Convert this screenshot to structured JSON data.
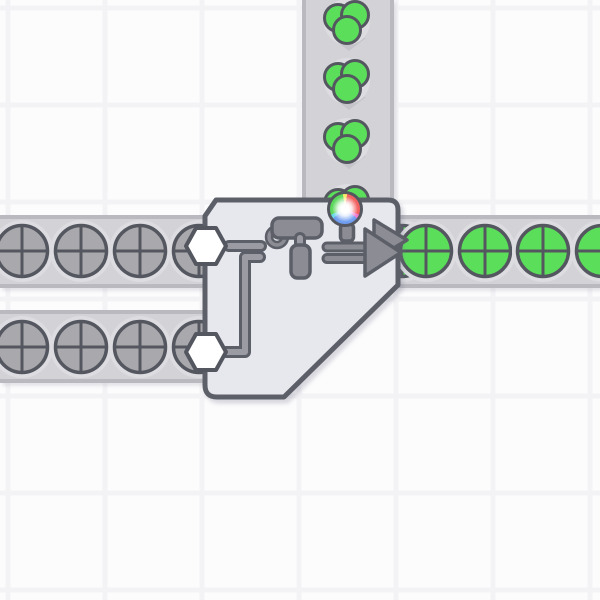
{
  "scene": {
    "kind": "factory-game-world",
    "background": {
      "color": "#fcfcfd",
      "grid": {
        "step": 97,
        "offset": 8,
        "line_width": 5,
        "line_color": "#f3f3f6"
      }
    },
    "colors": {
      "bg": "#fcfcfd",
      "grid-line": "#f3f3f6",
      "belt_fill": "#d2d2d7",
      "belt_edge": "#b9b9bf",
      "chevron": "#c4c4ca",
      "halo": "#dcdce1",
      "shape_grey": "#a9a9ad",
      "item_green": "#5bdf5b",
      "outline": "#54575f",
      "building_fill": "#e7e7ee",
      "building_outline": "#5c5f68",
      "icon_grey": "#8c8c94",
      "pipe_grey": "#9b9ba3",
      "hexagon_fill": "#ffffff",
      "wheel": {
        "red": "#f2605f",
        "green": "#5bd75b",
        "blue": "#6f9df0",
        "yellow": "#f4e96d",
        "cyan": "#6cd8e5",
        "magenta": "#ee7bd1",
        "center": "#ffffff"
      }
    },
    "belts": [
      {
        "name": "conveyor-belt-vertical-input",
        "orientation": "vertical",
        "direction": "down",
        "x": 302,
        "y": 0,
        "w": 92,
        "h": 203
      },
      {
        "name": "conveyor-belt-left-top",
        "orientation": "horizontal",
        "direction": "right",
        "x": 0,
        "y": 215,
        "w": 214,
        "h": 73
      },
      {
        "name": "conveyor-belt-left-bottom",
        "orientation": "horizontal",
        "direction": "right",
        "x": 0,
        "y": 310,
        "w": 214,
        "h": 73
      },
      {
        "name": "conveyor-belt-right-output",
        "orientation": "horizontal",
        "direction": "right",
        "x": 394,
        "y": 215,
        "w": 206,
        "h": 73
      }
    ],
    "belt_chevrons": [
      {
        "x": 349,
        "y": 38
      },
      {
        "x": 349,
        "y": 97
      },
      {
        "x": 349,
        "y": 156
      }
    ],
    "items": [
      {
        "kind": "color-blob",
        "color": "green",
        "x": 347,
        "y": 22
      },
      {
        "kind": "color-blob",
        "color": "green",
        "x": 347,
        "y": 81
      },
      {
        "kind": "color-blob",
        "color": "green",
        "x": 347,
        "y": 141
      },
      {
        "kind": "color-blob",
        "color": "green",
        "x": 347,
        "y": 207
      },
      {
        "kind": "circle-shape",
        "color": "grey",
        "x": 22,
        "y": 251
      },
      {
        "kind": "circle-shape",
        "color": "grey",
        "x": 81,
        "y": 251
      },
      {
        "kind": "circle-shape",
        "color": "grey",
        "x": 140,
        "y": 251
      },
      {
        "kind": "circle-shape",
        "color": "grey",
        "x": 199,
        "y": 251
      },
      {
        "kind": "circle-shape",
        "color": "grey",
        "x": 22,
        "y": 347
      },
      {
        "kind": "circle-shape",
        "color": "grey",
        "x": 81,
        "y": 347
      },
      {
        "kind": "circle-shape",
        "color": "grey",
        "x": 140,
        "y": 347
      },
      {
        "kind": "circle-shape",
        "color": "grey",
        "x": 199,
        "y": 347
      },
      {
        "kind": "circle-shape",
        "color": "green",
        "x": 402,
        "y": 251
      },
      {
        "kind": "circle-shape",
        "color": "green",
        "x": 426,
        "y": 251
      },
      {
        "kind": "circle-shape",
        "color": "green",
        "x": 485,
        "y": 251
      },
      {
        "kind": "circle-shape",
        "color": "green",
        "x": 543,
        "y": 251
      },
      {
        "kind": "circle-shape",
        "color": "green",
        "x": 602,
        "y": 251
      }
    ],
    "building": {
      "name": "painter-building",
      "kind": "double-painter",
      "x": 202,
      "y": 197,
      "w": 201,
      "h": 205,
      "inputs": 3,
      "outputs": 1,
      "parts": [
        "input-hexagon-top",
        "input-hexagon-bottom",
        "input-pipe-top",
        "input-pipe-bottom",
        "paint-roller-icon",
        "color-wheel-icon",
        "color-wheel-stem",
        "double-arrow-icon"
      ]
    }
  }
}
